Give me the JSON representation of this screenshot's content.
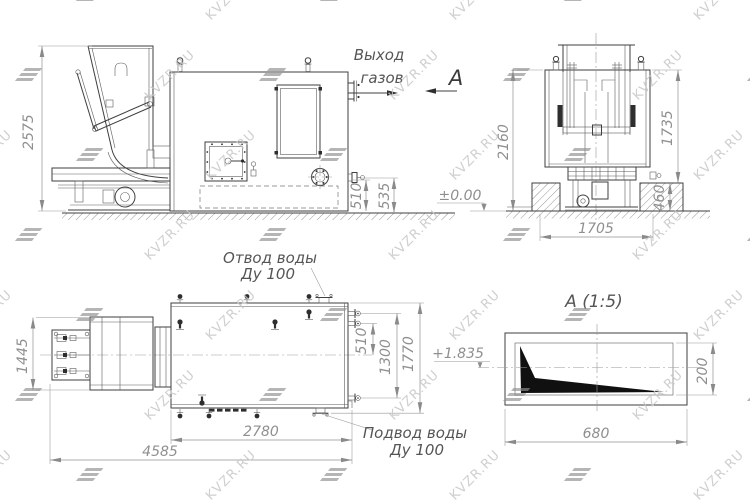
{
  "watermark": {
    "text": "KVZR.RU"
  },
  "front_view": {
    "labels": {
      "gas_outlet_line1": "Выход",
      "gas_outlet_line2": "газов",
      "section_mark": "А",
      "ground_level": "±0.00"
    },
    "dimensions": {
      "overall_height": "2575",
      "outlet_height": "510",
      "drain_height": "535"
    }
  },
  "side_view": {
    "dimensions": {
      "height_to_floor": "2160",
      "height_to_foundation": "1735",
      "foundation_height": "460",
      "width": "1705"
    }
  },
  "top_view": {
    "labels": {
      "water_outlet_line1": "Отвод воды",
      "water_outlet_line2": "Ду 100",
      "water_inlet_line1": "Подвод воды",
      "water_inlet_line2": "Ду 100",
      "pipe_level": "+1.835"
    },
    "dimensions": {
      "stoker_width": "1445",
      "outlet_offset": "510",
      "pipe_spacing": "1300",
      "body_width": "1770",
      "body_length": "2780",
      "overall_length": "4585"
    }
  },
  "detail_view": {
    "title": "А (1:5)",
    "dimensions": {
      "length": "680",
      "height": "200"
    }
  }
}
